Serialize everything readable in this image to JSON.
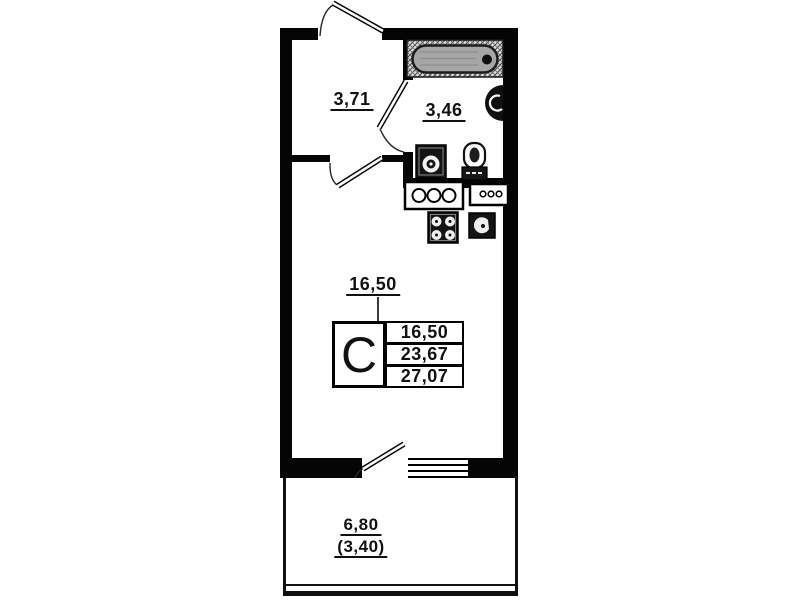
{
  "page": {
    "background": "#ffffff",
    "wall_color": "#050505"
  },
  "rooms": {
    "hallway": {
      "area": "3,71"
    },
    "bathroom": {
      "area": "3,46"
    },
    "living_room": {
      "area": "16,50"
    },
    "balcony": {
      "area": "6,80",
      "area_with_coefficient": "(3,40)"
    }
  },
  "legend": {
    "type": "С",
    "rows": [
      "16,50",
      "23,67",
      "27,07"
    ]
  },
  "fixtures": {
    "bathroom": [
      "bathtub-icon",
      "vent-shaft-icon",
      "washing-machine-icon",
      "toilet-icon"
    ],
    "kitchen": [
      "kitchen-counter-icon",
      "kitchen-module-icon",
      "stove-icon",
      "sink-icon"
    ],
    "doors": [
      "entrance-door-icon",
      "bathroom-door-icon",
      "interior-door-icon",
      "balcony-door-icon"
    ],
    "window": [
      "balcony-window-icon"
    ]
  },
  "colors": {
    "tub_fill": "#a6a6a6",
    "fixture_dark": "#141414",
    "hatch": "#4a4a4a"
  }
}
